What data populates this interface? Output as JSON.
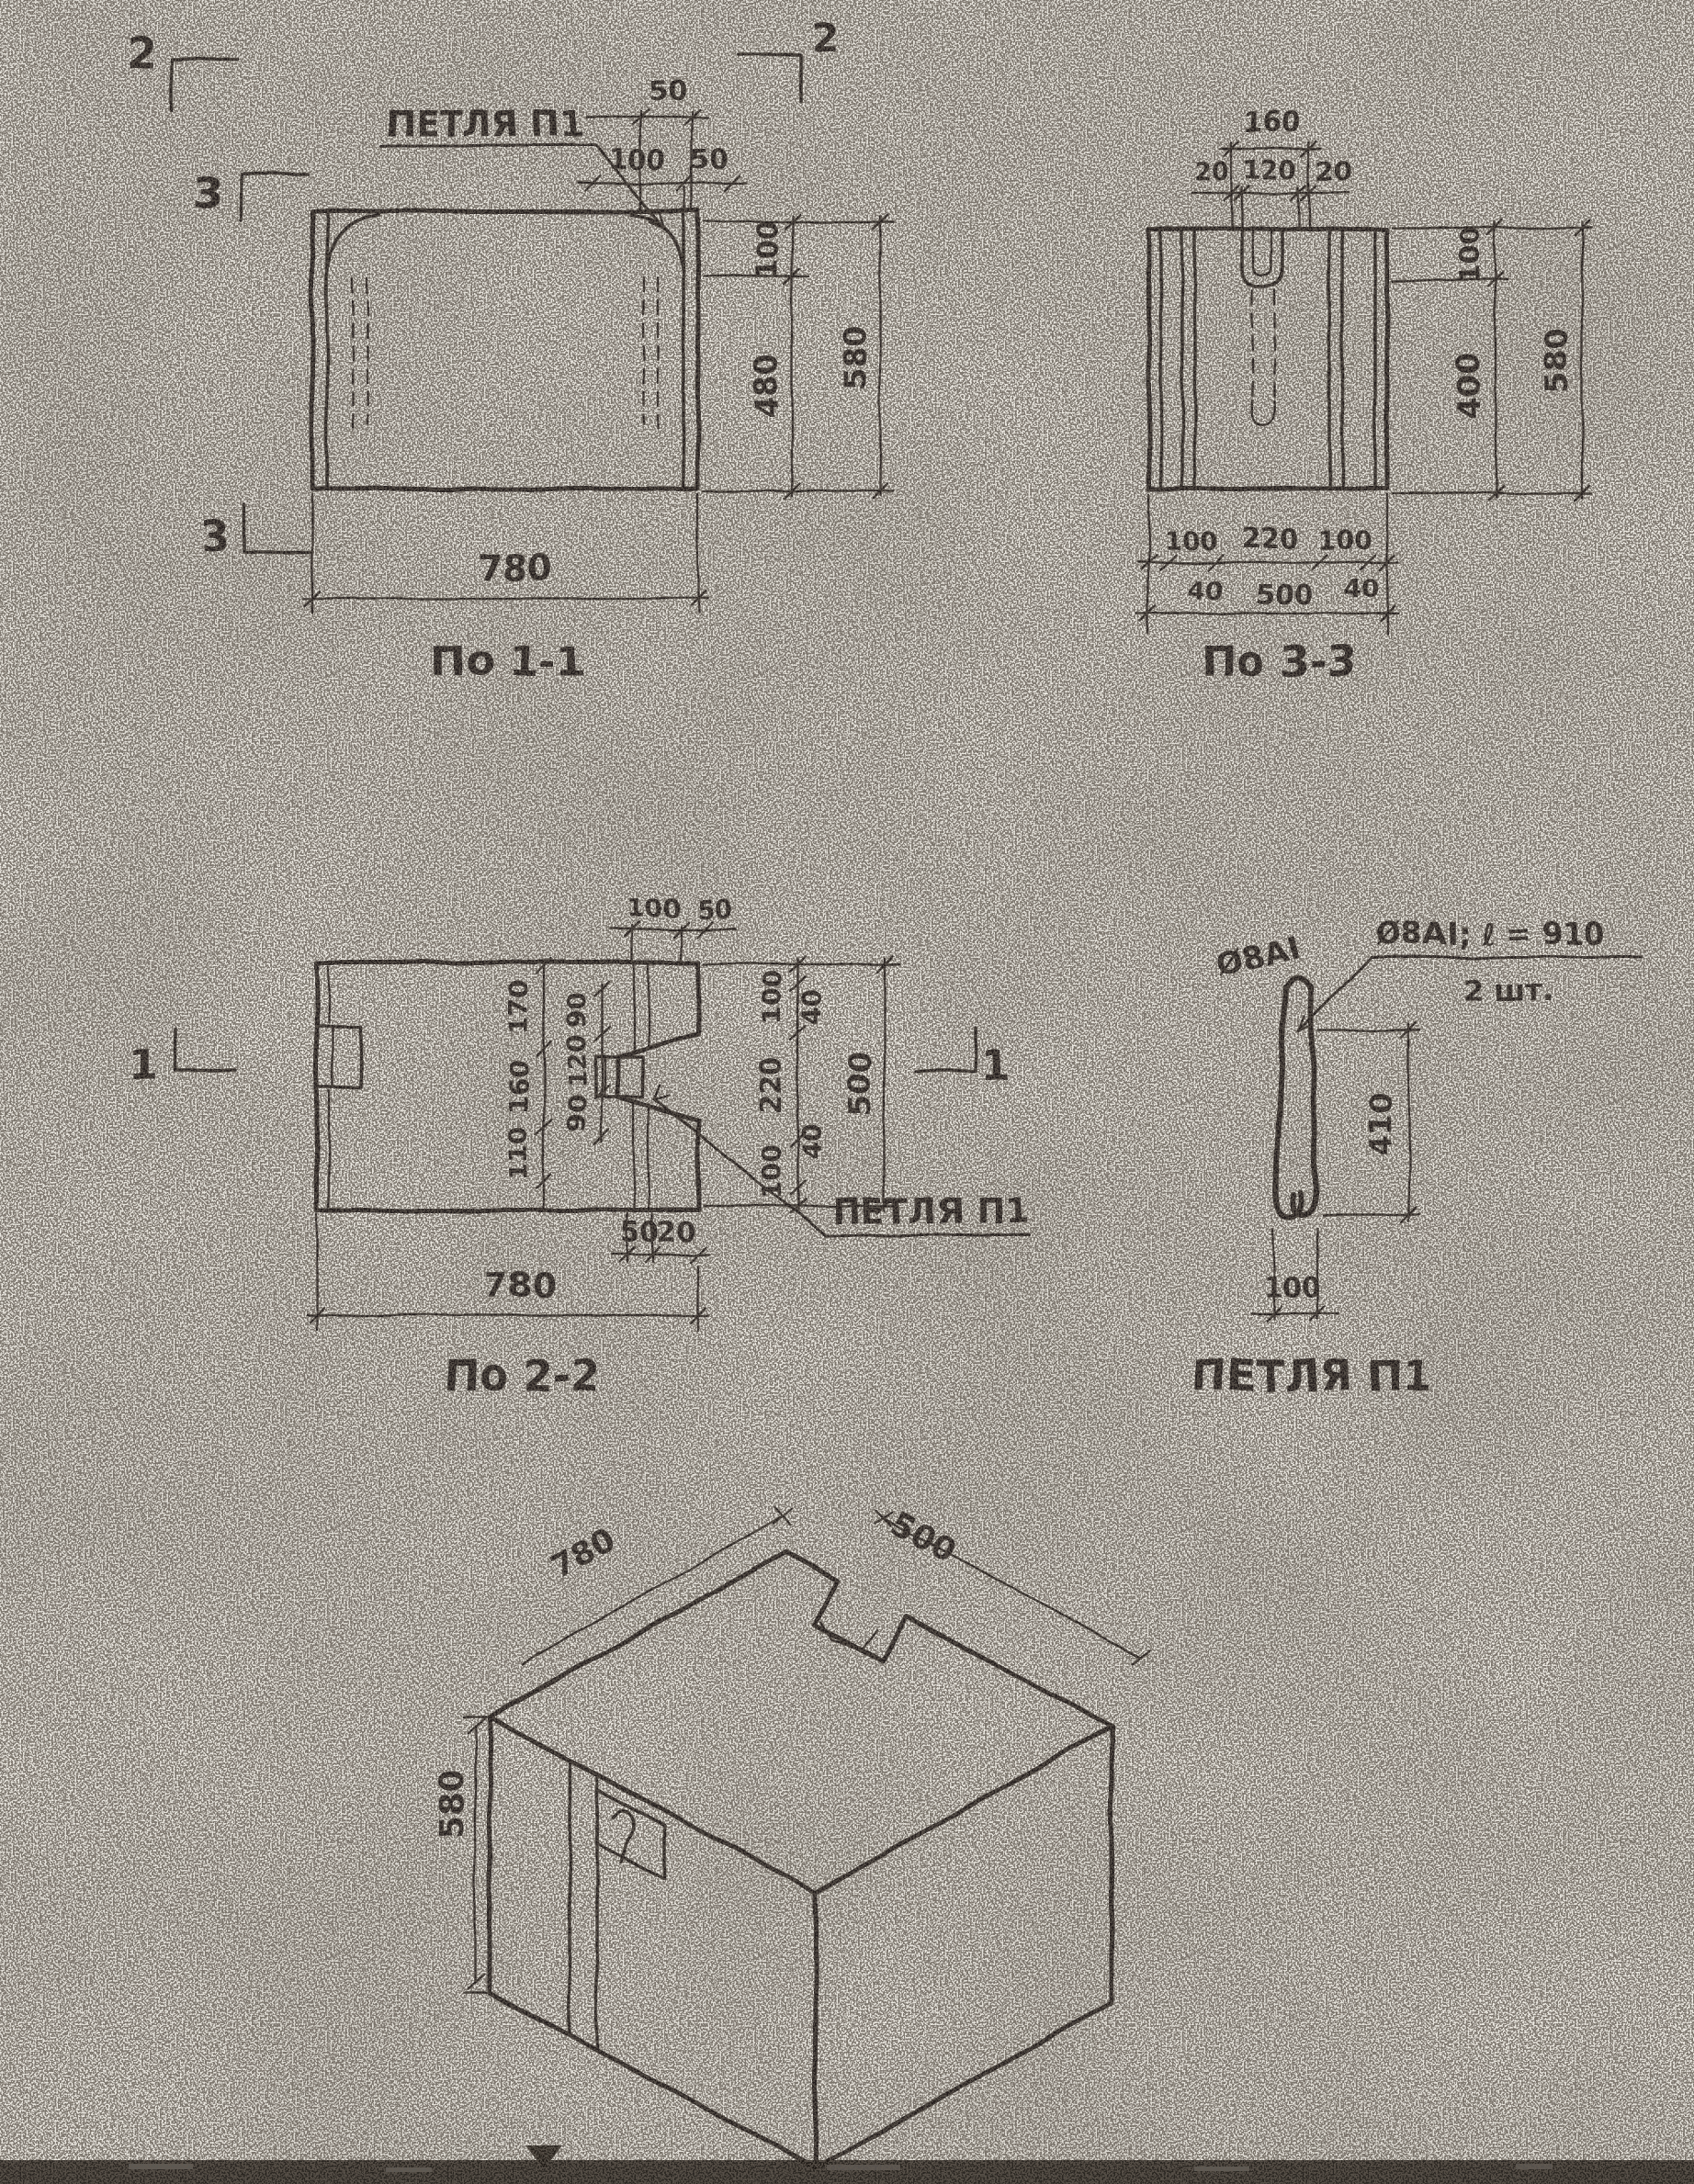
{
  "page": {
    "background": "#f1eee7",
    "ink": "#241f1a"
  },
  "section_1_1": {
    "caption": "По 1-1",
    "loop_label": "ПЕТЛЯ П1",
    "marker_top_left": "2",
    "marker_top_right": "2",
    "marker_side": "3",
    "marker_bottom": "3",
    "dim_recess_width": "50",
    "dim_top_100": "100",
    "dim_top_50": "50",
    "dim_right_top": "100",
    "dim_right_mid": "480",
    "dim_right_total": "580",
    "dim_width": "780"
  },
  "section_3_3": {
    "caption": "По 3-3",
    "dim_top_total": "160",
    "dim_top_left": "20",
    "dim_top_mid": "120",
    "dim_top_right": "20",
    "dim_right_top": "100",
    "dim_right_mid": "400",
    "dim_right_total": "580",
    "dim_bot_left": "100",
    "dim_bot_mid": "220",
    "dim_bot_right": "100",
    "dim_bot_40l": "40",
    "dim_bot_total": "500",
    "dim_bot_40r": "40"
  },
  "section_2_2": {
    "caption": "По 2-2",
    "loop_label": "ПЕТЛЯ П1",
    "marker_left": "1",
    "marker_right": "1",
    "dim_top_100": "100",
    "dim_top_50": "50",
    "dim_col1_a": "170",
    "dim_col1_b": "160",
    "dim_col1_c": "110",
    "dim_col2_a": "90",
    "dim_col2_b": "120",
    "dim_col2_c": "90",
    "dim_right_40t": "40",
    "dim_right_100t": "100",
    "dim_right_220": "220",
    "dim_right_100b": "100",
    "dim_right_40b": "40",
    "dim_right_total": "500",
    "dim_bot_50": "50",
    "dim_bot_20": "20",
    "dim_width": "780"
  },
  "loop_detail": {
    "caption": "ПЕТЛЯ П1",
    "bar_note": "Ø8АI",
    "callout_spec": "Ø8АI; ℓ = 910",
    "callout_qty": "2 шт.",
    "dim_height": "410",
    "dim_width": "100"
  },
  "isometric": {
    "dim_length": "780",
    "dim_depth": "500",
    "dim_height": "580"
  }
}
